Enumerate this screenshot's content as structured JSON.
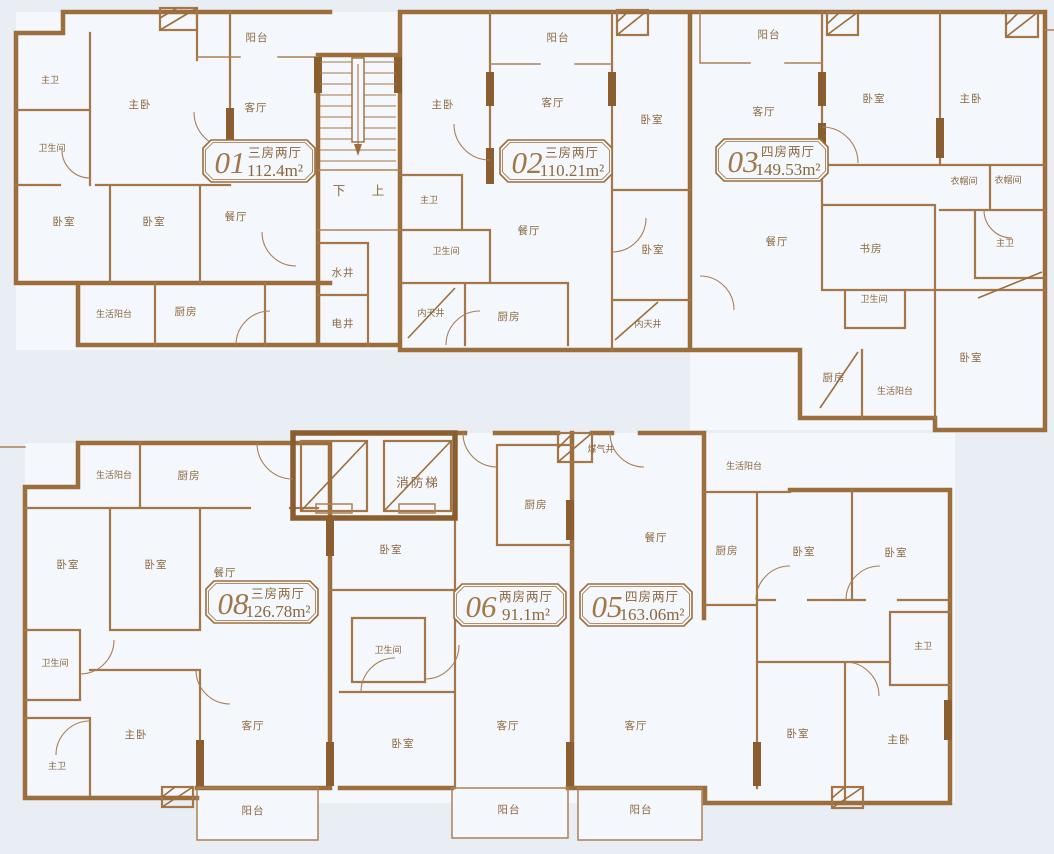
{
  "page": {
    "background": "#e9eef5",
    "wall_color": "#9c6e3c",
    "accent_dark": "#8a5e2f",
    "label_color": "#8a6840",
    "room_fill": "#f4f7fb"
  },
  "core": {
    "stairs_down": "下",
    "stairs_up": "上",
    "water_shaft": "水井",
    "electric_shaft": "电井",
    "fire_elevator": "消防梯",
    "gas_shaft": "煤气井"
  },
  "units": [
    {
      "id": "01",
      "layout": "三房两厅",
      "area": "112.4m²",
      "rooms": [
        "阳台",
        "主卫",
        "主卧",
        "客厅",
        "卫生间",
        "卧室",
        "卧室",
        "餐厅",
        "生活阳台",
        "厨房"
      ]
    },
    {
      "id": "02",
      "layout": "三房两厅",
      "area": "110.21m²",
      "rooms": [
        "阳台",
        "主卧",
        "客厅",
        "卧室",
        "主卫",
        "卫生间",
        "餐厅",
        "卧室",
        "内天井",
        "厨房",
        "内天井"
      ]
    },
    {
      "id": "03",
      "layout": "四房两厅",
      "area": "149.53m²",
      "rooms": [
        "阳台",
        "客厅",
        "卧室",
        "主卧",
        "衣帽间",
        "衣帽间",
        "餐厅",
        "书房",
        "主卫",
        "卫生间",
        "厨房",
        "生活阳台",
        "卧室"
      ]
    },
    {
      "id": "08",
      "layout": "三房两厅",
      "area": "126.78m²",
      "rooms": [
        "生活阳台",
        "厨房",
        "卧室",
        "卧室",
        "餐厅",
        "卫生间",
        "主卫",
        "主卧",
        "客厅",
        "阳台"
      ]
    },
    {
      "id": "06",
      "layout": "两房两厅",
      "area": "91.1m²",
      "rooms": [
        "厨房",
        "卧室",
        "卫生间",
        "卧室",
        "客厅",
        "阳台"
      ]
    },
    {
      "id": "05",
      "layout": "四房两厅",
      "area": "163.06m²",
      "rooms": [
        "生活阳台",
        "餐厅",
        "厨房",
        "卧室",
        "卧室",
        "主卫",
        "卧室",
        "主卧",
        "客厅",
        "阳台"
      ]
    }
  ]
}
